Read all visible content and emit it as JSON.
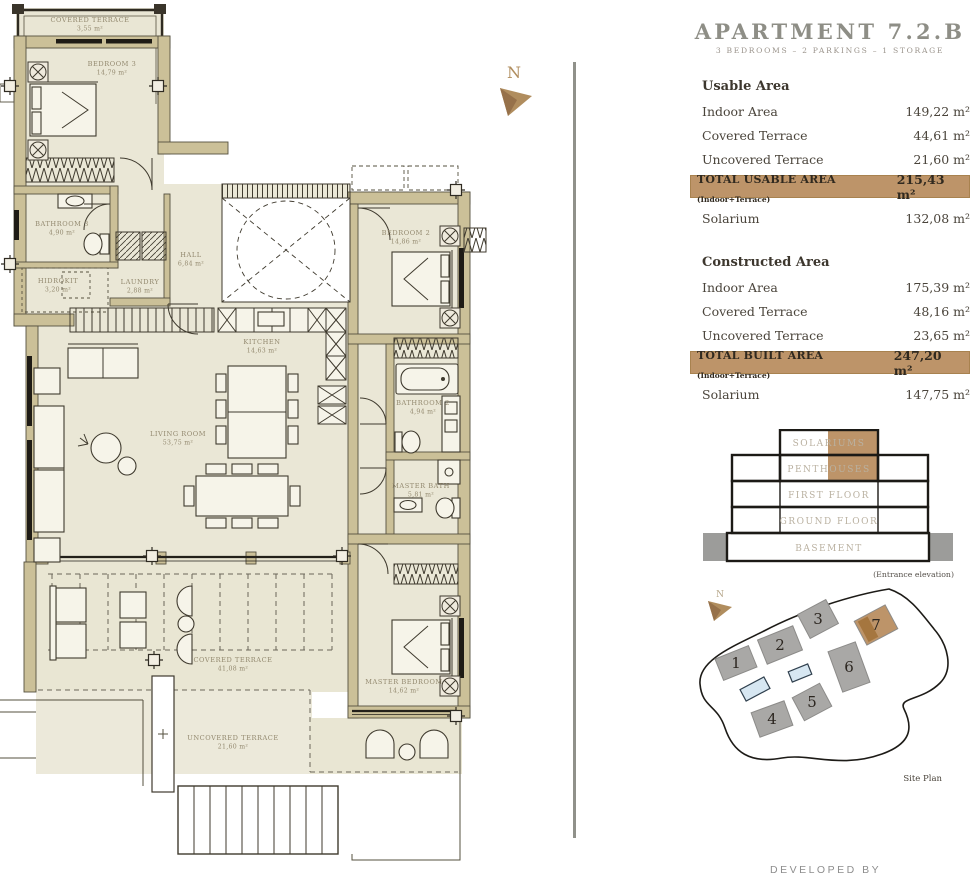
{
  "header": {
    "title": "APARTMENT 7.2.B",
    "subtitle": "3 BEDROOMS – 2 PARKINGS – 1 STORAGE"
  },
  "usable_area": {
    "heading": "Usable Area",
    "rows": [
      {
        "label": "Indoor Area",
        "value": "149,22 m²"
      },
      {
        "label": "Covered Terrace",
        "value": "44,61 m²"
      },
      {
        "label": "Uncovered Terrace",
        "value": "21,60 m²"
      }
    ],
    "total": {
      "label": "TOTAL USABLE AREA",
      "note": "(Indoor+Terrace)",
      "value": "215,43 m²"
    },
    "solarium": {
      "label": "Solarium",
      "value": "132,08 m²"
    }
  },
  "constructed_area": {
    "heading": "Constructed Area",
    "rows": [
      {
        "label": "Indoor Area",
        "value": "175,39 m²"
      },
      {
        "label": "Covered Terrace",
        "value": "48,16 m²"
      },
      {
        "label": "Uncovered Terrace",
        "value": "23,65 m²"
      }
    ],
    "total": {
      "label": "TOTAL BUILT AREA",
      "note": "(Indoor+Terrace)",
      "value": "247,20 m²"
    },
    "solarium": {
      "label": "Solarium",
      "value": "147,75 m²"
    }
  },
  "elevation": {
    "floors": [
      "SOLARIUMS",
      "PENTHOUSES",
      "FIRST FLOOR",
      "GROUND FLOOR",
      "BASEMENT"
    ],
    "caption": "(Entrance elevation)"
  },
  "site_plan": {
    "label": "Site Plan",
    "north_label": "N",
    "buildings": [
      {
        "number": "1",
        "x": 52,
        "y": 80,
        "w": 36,
        "h": 23,
        "rot": -22,
        "highlight": false
      },
      {
        "number": "2",
        "x": 96,
        "y": 62,
        "w": 38,
        "h": 26,
        "rot": -22,
        "highlight": false
      },
      {
        "number": "3",
        "x": 134,
        "y": 36,
        "w": 32,
        "h": 27,
        "rot": -28,
        "highlight": false
      },
      {
        "number": "7",
        "x": 192,
        "y": 42,
        "w": 35,
        "h": 27,
        "rot": -28,
        "highlight": true
      },
      {
        "number": "6",
        "x": 165,
        "y": 84,
        "w": 29,
        "h": 43,
        "rot": -20,
        "highlight": false
      },
      {
        "number": "5",
        "x": 128,
        "y": 119,
        "w": 31,
        "h": 26,
        "rot": -28,
        "highlight": false
      },
      {
        "number": "4",
        "x": 88,
        "y": 136,
        "w": 35,
        "h": 26,
        "rot": -20,
        "highlight": false
      }
    ],
    "pools": [
      {
        "x": 116,
        "y": 90,
        "w": 21,
        "h": 11,
        "rot": -22
      },
      {
        "x": 71,
        "y": 106,
        "w": 27,
        "h": 13,
        "rot": -28
      }
    ]
  },
  "floor_plan": {
    "north_label": "N",
    "rooms": [
      {
        "name": "COVERED TERRACE",
        "area": "3,55 m²",
        "x": 90,
        "y": 22
      },
      {
        "name": "BEDROOM 3",
        "area": "14,79 m²",
        "x": 112,
        "y": 66
      },
      {
        "name": "BATHROOM 3",
        "area": "4,90 m²",
        "x": 62,
        "y": 226
      },
      {
        "name": "HIDROKIT",
        "area": "3,20 m²",
        "x": 58,
        "y": 283
      },
      {
        "name": "LAUNDRY",
        "area": "2,88 m²",
        "x": 140,
        "y": 284
      },
      {
        "name": "HALL",
        "area": "6,84 m²",
        "x": 191,
        "y": 257
      },
      {
        "name": "KITCHEN",
        "area": "14,63 m²",
        "x": 262,
        "y": 344
      },
      {
        "name": "BEDROOM 2",
        "area": "14,86 m²",
        "x": 406,
        "y": 235
      },
      {
        "name": "LIVING ROOM",
        "area": "53,75 m²",
        "x": 178,
        "y": 436
      },
      {
        "name": "BATHROOM 2",
        "area": "4,94 m²",
        "x": 423,
        "y": 405
      },
      {
        "name": "MASTER BATH",
        "area": "5,81 m²",
        "x": 421,
        "y": 488
      },
      {
        "name": "MASTER BEDROOM",
        "area": "14,62 m²",
        "x": 404,
        "y": 684
      },
      {
        "name": "COVERED TERRACE",
        "area": "41,08 m²",
        "x": 233,
        "y": 662
      },
      {
        "name": "UNCOVERED TERRACE",
        "area": "21,60 m²",
        "x": 233,
        "y": 740
      }
    ]
  },
  "footer": {
    "developed_by": "DEVELOPED BY"
  },
  "colors": {
    "accent_tan": "#bd9469",
    "wall_fill": "#cbc098",
    "floor_fill": "#eae7d6",
    "building_gray": "#a9a8a6",
    "pool_blue": "#d7e7f2",
    "title_gray": "#8e8e86"
  }
}
